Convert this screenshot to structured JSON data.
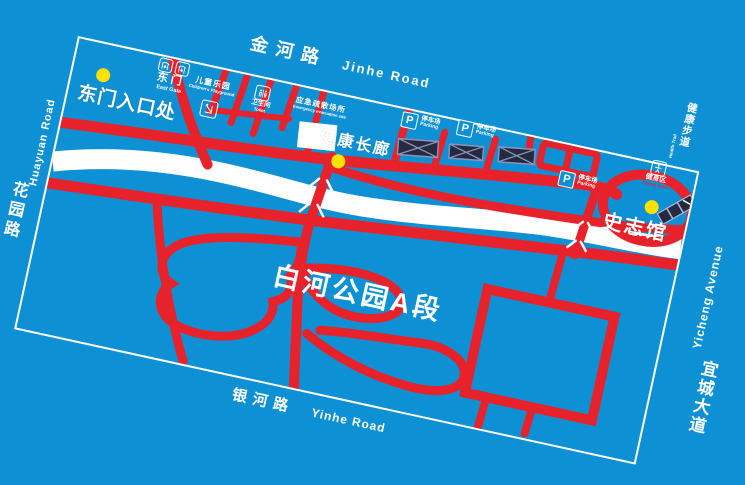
{
  "title": {
    "cn": "白河公园A段"
  },
  "colors": {
    "background_blue": "#0e90d4",
    "path_red": "#e8222a",
    "river_white": "#ffffff",
    "marker_yellow": "#ffe100",
    "structure_dark": "#252a3f",
    "structure_line": "#8b93bb"
  },
  "roads": {
    "top": {
      "cn": "金河路",
      "en": "Jinhe Road"
    },
    "bottom": {
      "cn": "银河路",
      "en": "Yinhe Road"
    },
    "left": {
      "cn": "花园路",
      "en": "Huayuan Road"
    },
    "right": {
      "cn": "宜城大道",
      "en": "Yicheng Avenue"
    }
  },
  "pois": {
    "east_entrance": {
      "cn": "东门入口处"
    },
    "corridor": {
      "cn": "健康长廊"
    },
    "museum": {
      "cn": "史志馆"
    }
  },
  "facilities": {
    "east_gate": {
      "cn": "东门",
      "en": "East Gate"
    },
    "playground": {
      "cn": "儿童乐园",
      "en": "Children's Playground"
    },
    "toilet": {
      "cn": "卫生间",
      "en": "Toilet"
    },
    "emergency": {
      "cn": "应急疏散场所",
      "en": "Emergency evacuation site"
    },
    "parking": {
      "cn": "停车场",
      "en": "Parking",
      "sign": "P"
    },
    "fitness": {
      "cn": "健身区",
      "en": "Fitness Area"
    },
    "trail": {
      "cn": "健康步道",
      "en": "Health Trail"
    }
  }
}
